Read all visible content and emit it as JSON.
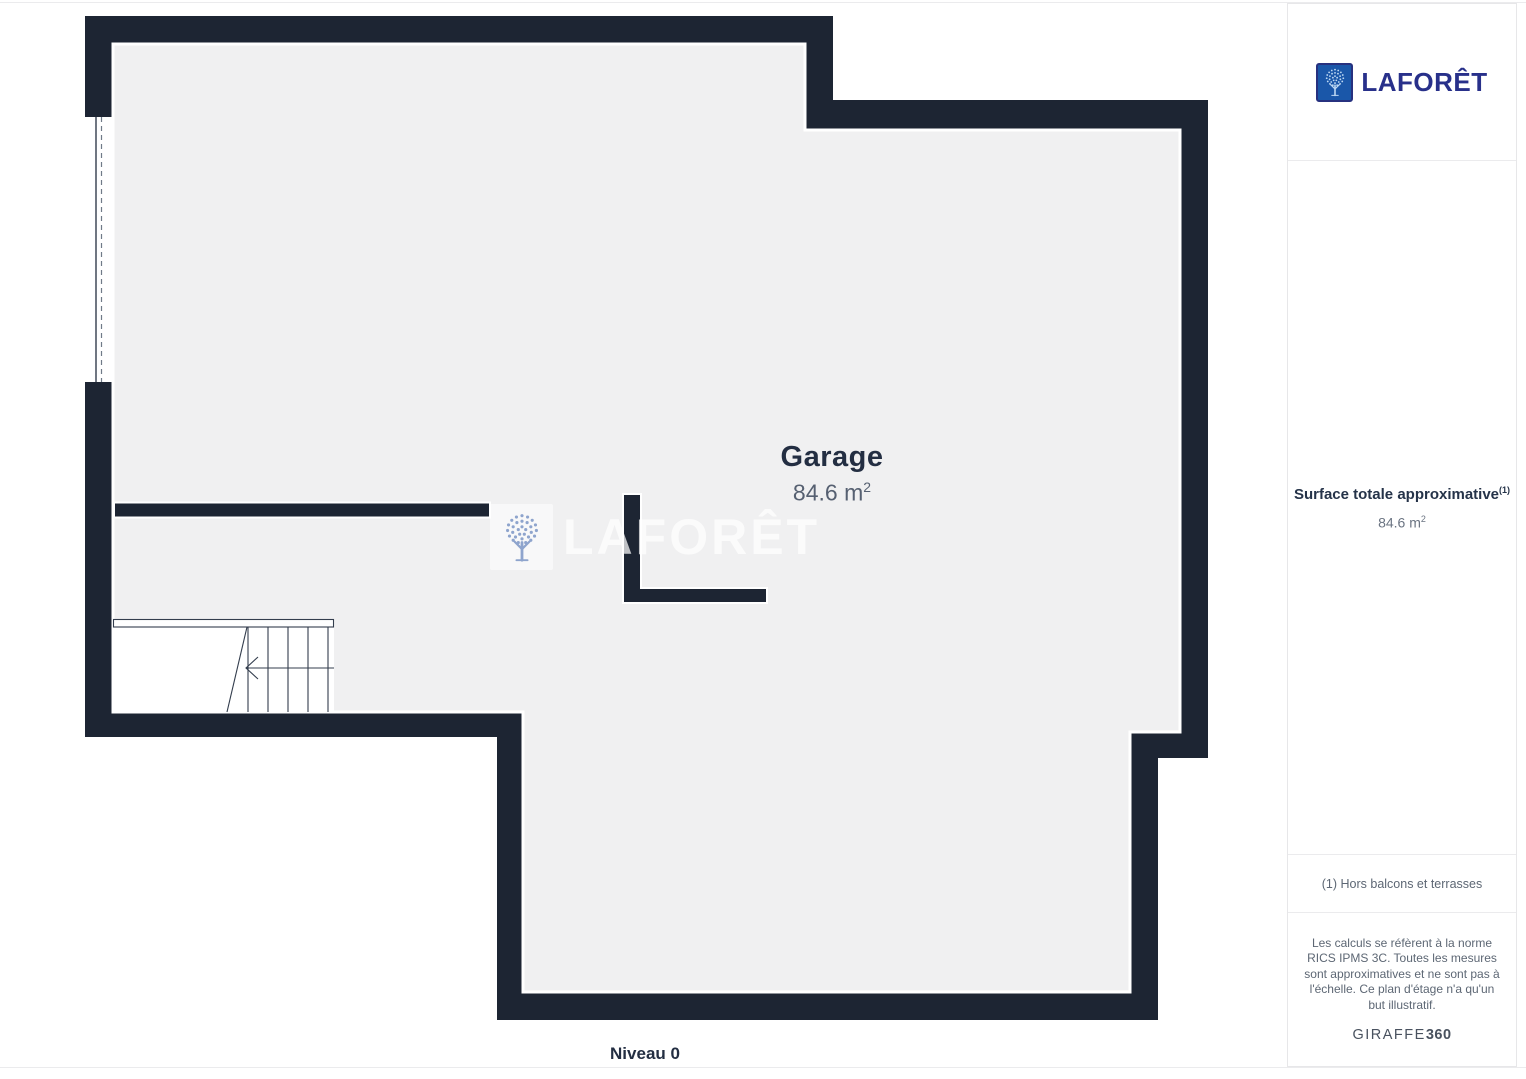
{
  "plan": {
    "room": {
      "name": "Garage",
      "area_value": "84.6 m",
      "area_sup": "2"
    },
    "level_label": "Niveau 0",
    "watermark_text": "LAFORÊT"
  },
  "sidebar": {
    "brand_wordmark": "LAFORÊT",
    "surface": {
      "title": "Surface totale approximative",
      "title_sup": "(1)",
      "value": "84.6 m",
      "value_sup": "2"
    },
    "footnote": "(1) Hors balcons et terrasses",
    "legal": "Les calculs se réfèrent à la norme RICS IPMS 3C. Toutes les mesures sont approximatives et ne sont pas à l'échelle. Ce plan d'étage n'a qu'un but illustratif.",
    "credit": {
      "brand": "GIRAFFE",
      "suffix": "360"
    }
  },
  "colors": {
    "wall": "#1d2533",
    "floor": "#f0f0f1",
    "plan_lines": "#333d4d",
    "brand_blue": "#1a57a9",
    "brand_navy": "#28308a",
    "watermark_tree": "#8ea4cd",
    "text_dark": "#232e42",
    "text_gray": "#5d6774"
  }
}
